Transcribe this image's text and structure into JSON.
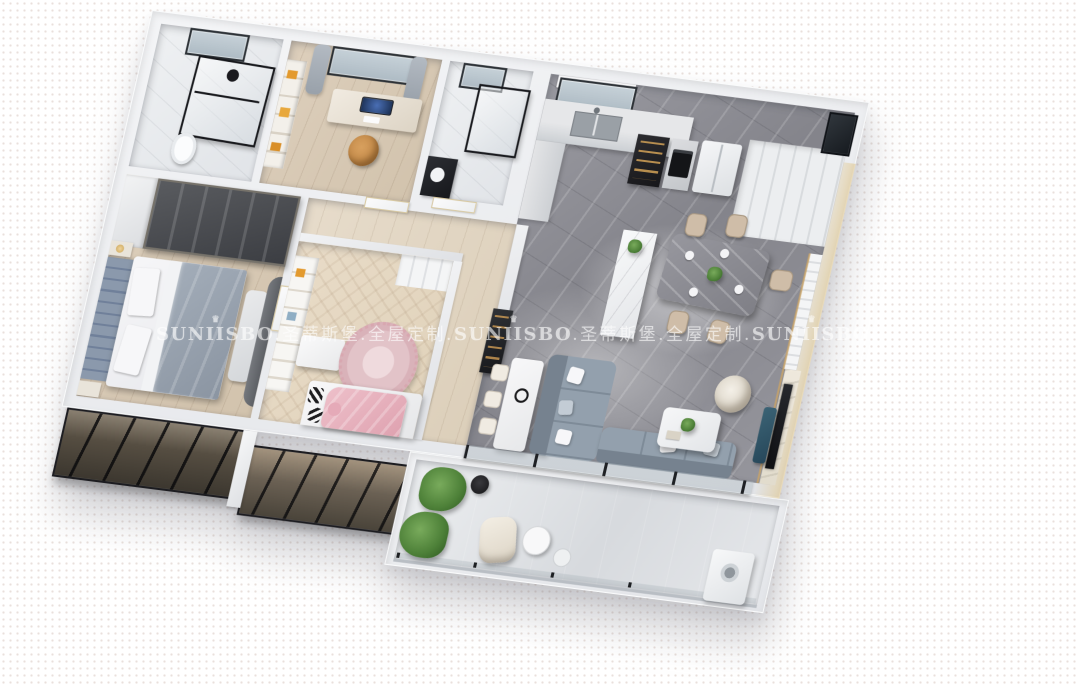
{
  "watermark": {
    "brand": "SUNIISBO",
    "brand_cn": "圣蒂斯堡",
    "tagline_cn": "全屋定制",
    "separator": ".",
    "crown_icon": "crown-icon",
    "crown_glyph": "♛",
    "repetitions": 3,
    "color": "#FFFFFF",
    "opacity": 0.58
  },
  "scene": {
    "type": "3d_apartment_floorplan_render",
    "view": "oblique_birds_eye_cutaway",
    "style": "modern gray, white and light-wood interior",
    "rooms": [
      {
        "id": "bathroom-master",
        "features": [
          "glass-shower-enclosure",
          "rain-shower-head",
          "toilet",
          "marble-walls",
          "window"
        ]
      },
      {
        "id": "study",
        "features": [
          "desk",
          "imac-monitor",
          "desk-chair",
          "bookshelf-with-orange-books",
          "window",
          "gray-curtains"
        ]
      },
      {
        "id": "bathroom-second",
        "features": [
          "glass-shower-panel",
          "black-vanity-counter",
          "window"
        ]
      },
      {
        "id": "kitchen",
        "features": [
          "window-with-roller-shade",
          "sink-counter",
          "dark-display-cabinet",
          "built-in-oven",
          "double-door-refrigerator",
          "tall-white-cabinets",
          "corner-window"
        ]
      },
      {
        "id": "dining-area",
        "features": [
          "white-marble-island",
          "gray-marble-dining-table",
          "beige-dining-chairs",
          "centerpiece-plant",
          "gold-slat-accent-wall"
        ]
      },
      {
        "id": "living-room",
        "features": [
          "gray-l-shaped-sofa",
          "white-throw-pillows",
          "work-table-with-chairs",
          "headphones",
          "white-coffee-table",
          "cream-swivel-armchair",
          "marble-tv-wall",
          "television",
          "teal-media-console"
        ]
      },
      {
        "id": "master-bedroom",
        "features": [
          "dark-wardrobe-shelving",
          "channel-tufted-headboard",
          "double-bed-gray-duvet",
          "foot-bench",
          "arched-accent-wall",
          "nightstands-with-gold-lamps"
        ]
      },
      {
        "id": "kids-bedroom",
        "features": [
          "white-bookshelf-desk",
          "round-pink-rug",
          "bed-with-pink-blanket",
          "black-white-zigzag-pillows",
          "wardrobe"
        ]
      },
      {
        "id": "hallway",
        "features": [
          "white-doors-gold-trim",
          "wood-floor",
          "dark-wine-cabinet"
        ]
      },
      {
        "id": "balcony",
        "features": [
          "potted-green-plants",
          "cream-lounge-chair",
          "black-round-side-table",
          "white-round-table",
          "washing-machine",
          "black-framed-glass-doors"
        ]
      }
    ],
    "exterior": [
      "brown-bay-window-boxes",
      "soft-building-shadow",
      "dotted-white-backdrop"
    ]
  },
  "palette": {
    "background": "#FFFFFF",
    "background_dots": "#E9E0DC",
    "outer_wall": "#EDEEF1",
    "marble_floor_gray": "#8E8E95",
    "wood_floor": "#D8CAB8",
    "herringbone_floor": "#E4D6C2",
    "sofa_gray": "#8E99A6",
    "dining_chair_beige": "#CFBDA8",
    "pink_blanket": "#E7B3BE",
    "headboard_blue_gray": "#7E8CA0",
    "bay_window_brown": "#6A6052",
    "accent_gold": "#C9A468",
    "plant_green": "#4D8038",
    "shower_frame_black": "#17181C"
  }
}
